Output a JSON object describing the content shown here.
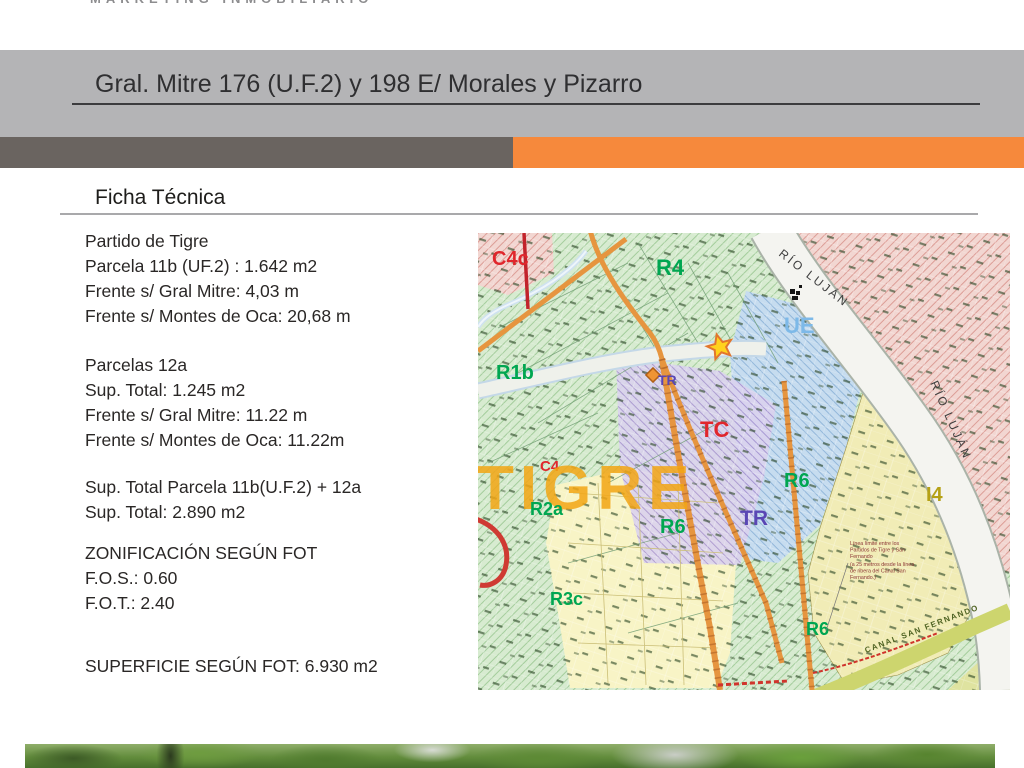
{
  "brand": {
    "tagline": "MARKETING INMOBILIARIO"
  },
  "title_bar": {
    "title": "Gral. Mitre 176 (U.F.2) y 198 E/ Morales y Pizarro",
    "band_gray": "#b4b4b6",
    "bar_dark_gray": "#6a6460",
    "bar_orange": "#f6893c"
  },
  "section": {
    "heading": "Ficha Técnica"
  },
  "facts": {
    "block1": [
      "Partido de Tigre",
      "Parcela 11b (UF.2) : 1.642 m2",
      "Frente s/ Gral Mitre: 4,03 m",
      "Frente s/ Montes de Oca: 20,68 m"
    ],
    "block2": [
      "Parcelas 12a",
      "Sup. Total: 1.245 m2",
      "Frente s/ Gral Mitre: 11.22 m",
      "Frente s/ Montes de Oca: 11.22m"
    ],
    "block3": [
      "Sup. Total Parcela 11b(U.F.2) + 12a",
      "Sup. Total:  2.890 m2"
    ],
    "block4": [
      "ZONIFICACIÓN SEGÚN FOT",
      "F.O.S.: 0.60",
      "F.O.T.: 2.40"
    ],
    "block5": [
      "SUPERFICIE SEGÚN FOT: 6.930 m2"
    ]
  },
  "map": {
    "watermark": "TIGRE",
    "river_label_1": "RÍO LUJÁN",
    "river_label_2": "RÍO LUJÁN",
    "canal_label": "CANAL SAN FERNANDO",
    "zones": {
      "c4c": "C4c",
      "r4": "R4",
      "r1b": "R1b",
      "ue": "UE",
      "tc": "TC",
      "tr": "TR",
      "tr_small": "TR",
      "r6_east": "R6",
      "r6_mid": "R6",
      "r6_south": "R6",
      "i4": "I4",
      "r2a": "R2a",
      "c4": "C4",
      "r3c": "R3c"
    },
    "annotation": {
      "l1": "Línea límite entre los",
      "l2": "Partidos de Tigre y San",
      "l3": "Fernando",
      "l4": "(a 25 metros desde la línea",
      "l5": "de ribera del Canal San",
      "l6": "Fernando.)"
    },
    "colors": {
      "green_label": "#00a651",
      "red_label": "#e0262c",
      "blue_label": "#7db9e8",
      "purple_label": "#5a46b4",
      "olive_label": "#b5a116",
      "watermark": "#f3a614",
      "gray_label": "#3f3f3f",
      "canal_label": "#4f6323"
    }
  }
}
